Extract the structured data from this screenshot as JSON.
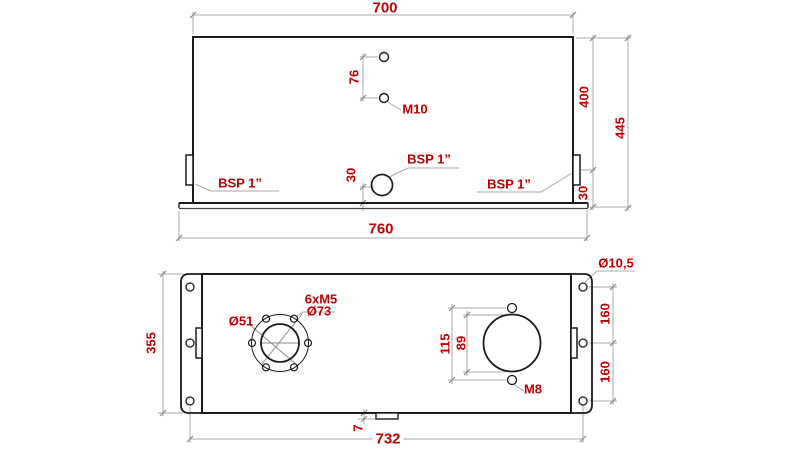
{
  "colors": {
    "label_red": "#c00000",
    "object_line": "#1b1b1b",
    "dimension_line": "#a8a8a8"
  },
  "front_view": {
    "dim_width_top": "700",
    "dim_width_base": "760",
    "dim_height_body": "400",
    "dim_height_total": "445",
    "dim_hole_spacing": "76",
    "dim_drain_offset": "30",
    "dim_side_port_offset": "30",
    "label_top_holes": "M10",
    "label_port_left": "BSP 1”",
    "label_port_drain": "BSP 1”",
    "label_port_right": "BSP 1”"
  },
  "plan_view": {
    "dim_depth": "355",
    "dim_mount_hole_pitch": "732",
    "dim_notch_depth": "7",
    "dim_filler_hole_spacing": "115",
    "dim_filler_opening": "89",
    "dim_flange_hole_spacing_upper": "160",
    "dim_flange_hole_spacing_lower": "160",
    "label_mount_hole_dia": "Ø10,5",
    "label_filler_screws": "M8",
    "label_suction_inner_dia": "Ø51",
    "label_suction_bolt_circle": "Ø73",
    "label_suction_bolts": "6xM5"
  }
}
